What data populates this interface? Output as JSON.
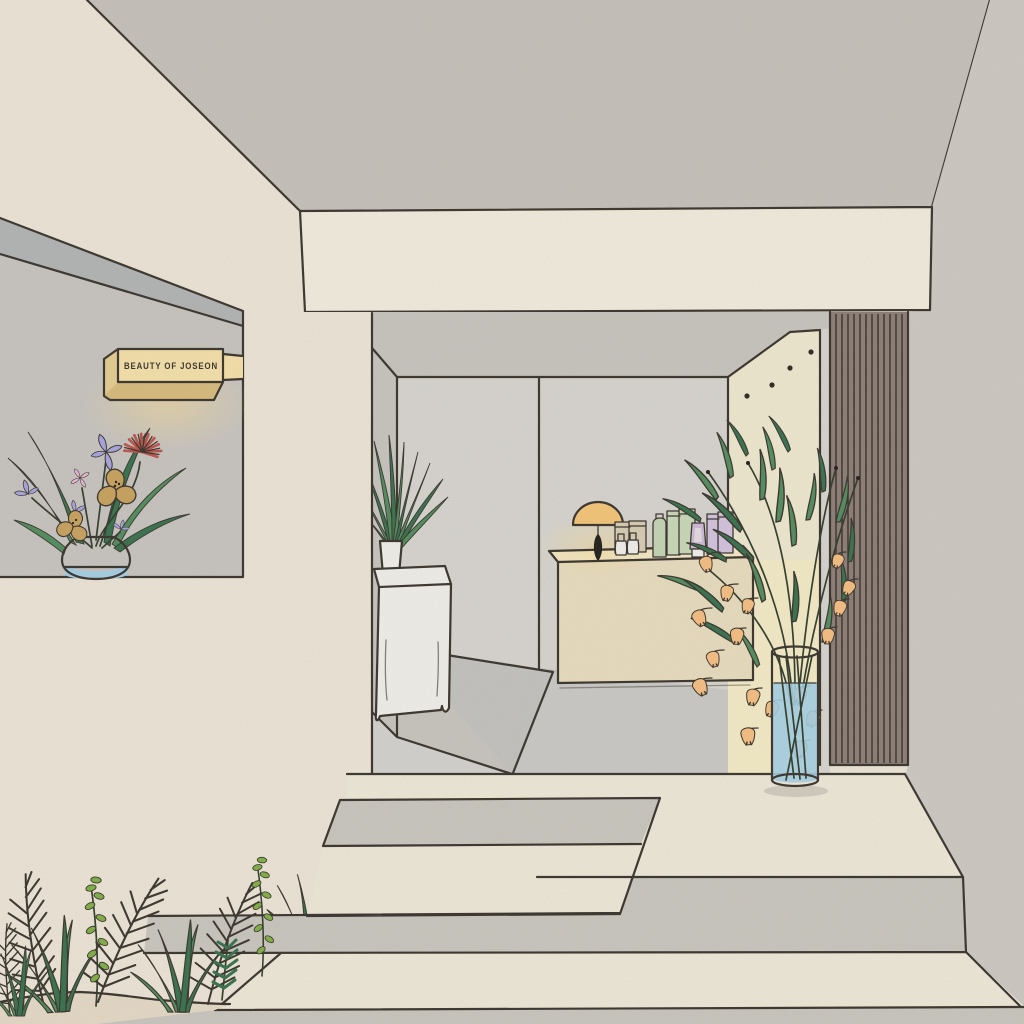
{
  "sign": {
    "text": "BEAUTY OF JOSEON"
  },
  "scene": {
    "type": "illustration",
    "description": "Hand-drawn illustration of a minimalist beauty-shop storefront: grey ceiling, cream beam, interior with display counter, table lamp and skincare products, wood slat panel, tall vase of bell flowers, entrance steps and garden plants",
    "objects": [
      "shop-sign",
      "window-flower-arrangement",
      "storefront-beam",
      "interior-wall-panels",
      "display-counter",
      "table-lamp",
      "dropper-bottles",
      "tan-product-boxes",
      "green-bottle-and-boxes",
      "purple-tube-and-boxes",
      "pedestal-with-potted-plant",
      "wall-dots",
      "wood-slat-panel",
      "tall-vase-with-bell-flowers",
      "entrance-platform-and-steps",
      "planter-mound-with-garden-plants"
    ]
  },
  "palette": {
    "paper": "#efe8da",
    "ceiling": "#c7c3bc",
    "wallgrey": "#cfcbc5",
    "beam": "#f4efe1",
    "band": "#b3b6b7",
    "niche": "#c9c6c2",
    "panel": "#d9d7d2",
    "interiorbg": "#c9c6c1",
    "accentwall": "#f2ebd2",
    "accentwall2": "#f6eec9",
    "slats": "#8c7e76",
    "slatline": "#352d29",
    "floor": "#c4c4c2",
    "floorlight": "#d5d4d1",
    "floormid": "#cbcbc9",
    "countertop": "#f6ecca",
    "counterfront": "#eadfc0",
    "stepgrey": "#cbc8c1",
    "creamstep": "#f1ebdc",
    "mound": "#e6dcc8",
    "water": "#a5d1e8",
    "lamp": "#f7c778",
    "leaf": "#4f8d5d",
    "leafdark": "#35714c",
    "leafbright": "#7fb143",
    "bell": "#f8c083",
    "iris": "#a7a5e2",
    "pink": "#ecb9dc",
    "tanflower": "#c9a35e",
    "redflower": "#bf5048",
    "signface": "#f7e3ab",
    "signside": "#e7cf92",
    "signbottom": "#d9bd7d",
    "pot": "#f3f2ee",
    "greenbox": "#cbdbbb",
    "greenbottle": "#c6d7b7",
    "purplebox": "#d6c4e1",
    "purpletube": "#cfbbdb",
    "tanbox": "#d8cfb4",
    "outline": "#37322b",
    "black": "#1e1c1a"
  }
}
